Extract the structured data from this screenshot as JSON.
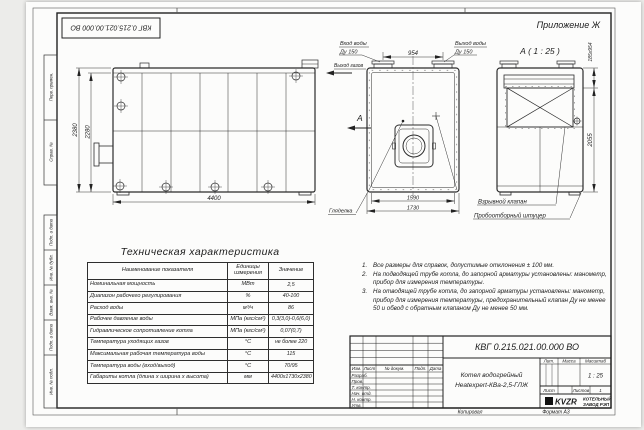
{
  "frame": {
    "appendix": "Приложение Ж",
    "stamp_doc_number": "КВГ 0.215.021.00.000 ВО",
    "left_labels": {
      "perv_primen": "Перв. примен.",
      "sprav_no": "Справ. №",
      "podp_data1": "Подп. и дата",
      "inv_dubl": "Инв. № дубл.",
      "vzam_inv": "Взам. инв. №",
      "podp_data2": "Подп. и дата",
      "inv_podl": "Инв. № подл."
    },
    "kopiroval": "Копировал",
    "format": "Формат А3"
  },
  "views": {
    "side": {
      "dim_height_outer": "2380",
      "dim_height_inner": "2280",
      "dim_length": "4400"
    },
    "front": {
      "label_water_in_1": "Вход воды",
      "label_water_in_2": "Ду 150",
      "label_water_out_1": "Выход воды",
      "label_water_out_2": "Ду 150",
      "label_gas_out": "Выход газов",
      "dim_top": "954",
      "section_mark": "А",
      "dim_width_inner": "1590",
      "dim_width_outer": "1730",
      "label_sight_glass": "Гляделка"
    },
    "section_a": {
      "title": "А ( 1 : 25 )",
      "dim_top": "185х954",
      "dim_height": "2055",
      "label_explosion_valve": "Взрывной клапан",
      "label_sampling_fitting": "Пробоотборный штуцер"
    }
  },
  "tech_table": {
    "title": "Техническая характеристика",
    "headers": [
      "Наименование показателя",
      "Единицы измерения",
      "Значение"
    ],
    "rows": [
      [
        "Номинальная мощность",
        "МВт",
        "2,5"
      ],
      [
        "Диапазон рабочего регулирования",
        "%",
        "40-100"
      ],
      [
        "Расход воды",
        "м³/ч",
        "86"
      ],
      [
        "Рабочее давление воды",
        "МПа (кгс/см²)",
        "0,3(3,0)-0,6(6,0)"
      ],
      [
        "Гидравлическое сопротивление котла",
        "МПа (кгс/см²)",
        "0,07(0,7)"
      ],
      [
        "Температура уходящих газов",
        "°С",
        "не более 220"
      ],
      [
        "Максимальная рабочая температура воды",
        "°С",
        "115"
      ],
      [
        "Температура воды (вход/выход)",
        "°С",
        "70/95"
      ],
      [
        "Габариты котла (длина х ширина х высота)",
        "мм",
        "4400х1730х2380"
      ]
    ]
  },
  "notes": {
    "items": [
      {
        "num": "1.",
        "text": "Все размеры для справок, допустимые отклонения ± 100 мм."
      },
      {
        "num": "2.",
        "text": "На подводящей трубе котла, до запорной арматуры установлены: манометр, прибор для измерения температуры."
      },
      {
        "num": "3.",
        "text": "На отводящей трубе котла, до запорной арматуры установлены: манометр, прибор для измерения температуры, предохранительный клапан Ду не менее 50 и обвод с обратным клапаном Ду не менее 50 мм."
      }
    ]
  },
  "title_block": {
    "doc_number": "КВГ 0.215.021.00.000 ВО",
    "product_name_1": "Котел водогрейный",
    "product_name_2": "Heatexpert-КВа-2,5-ГЛЖ",
    "col_izm": "Изм.",
    "col_list": "Лист",
    "col_doc": "№ докум.",
    "col_podp": "Подп.",
    "col_data": "Дата",
    "row_razrab": "Разраб.",
    "row_prov": "Пров.",
    "row_tkontr": "Т. контр.",
    "row_nachotd": "Нач. отд.",
    "row_nkontr": "Н. контр.",
    "row_utv": "Утв.",
    "lit_label": "Лит.",
    "massa_label": "Масса",
    "masshtab_label": "Масштаб",
    "scale_value": "1 : 25",
    "list_label": "Лист",
    "listov_label": "Листов",
    "listov_value": "1",
    "logo_text": "KVZR",
    "company_line1": "КОТЕЛЬНЫЙ",
    "company_line2": "ЗАВОД РЭП",
    "line_color": "#1c1c1c"
  }
}
